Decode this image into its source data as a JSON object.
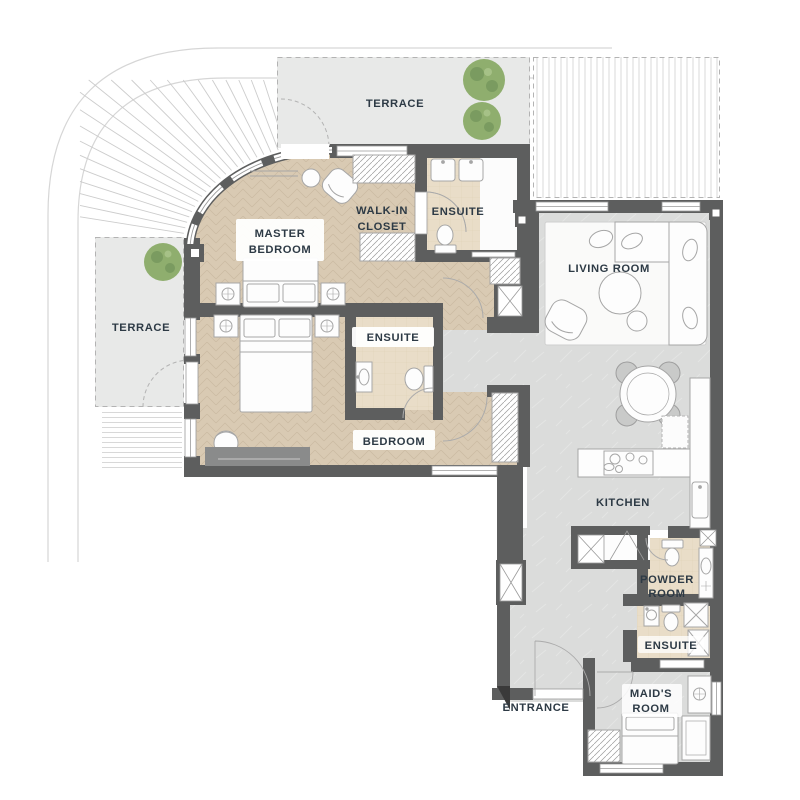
{
  "plan": {
    "terrace_top": "TERRACE",
    "terrace_left": "TERRACE",
    "master_l1": "MASTER",
    "master_l2": "BEDROOM",
    "walkin_l1": "WALK-IN",
    "walkin_l2": "CLOSET",
    "ensuite_top": "ENSUITE",
    "ensuite_mid": "ENSUITE",
    "ensuite_low": "ENSUITE",
    "living": "LIVING ROOM",
    "bedroom": "BEDROOM",
    "kitchen": "KITCHEN",
    "powder_l1": "POWDER",
    "powder_l2": "ROOM",
    "maid_l1": "MAID'S",
    "maid_l2": "ROOM",
    "entrance": "ENTRANCE"
  },
  "colors": {
    "wall": "#5d5e5e",
    "wood": "#d9cab3",
    "wood_line": "#c7b69c",
    "tile": "#dbdcdb",
    "tile_line": "#e4e5e4",
    "bath": "#e9ddc8",
    "bath_line": "#decfb4",
    "terrace": "#e8e9e8",
    "stripe": "#d8d8d8",
    "label": "#2d3a45",
    "tree": "#8fae6e",
    "tree_dark": "#71935a",
    "furn_line": "#a6a6a6",
    "dash": "#b3b3b3",
    "rug": "#fafaf9",
    "chair_gray": "#c9cac9",
    "dresser": "#8a8b8b",
    "boundary": "#d6d6d6",
    "fan": "#cccccc",
    "white": "#ffffff"
  }
}
